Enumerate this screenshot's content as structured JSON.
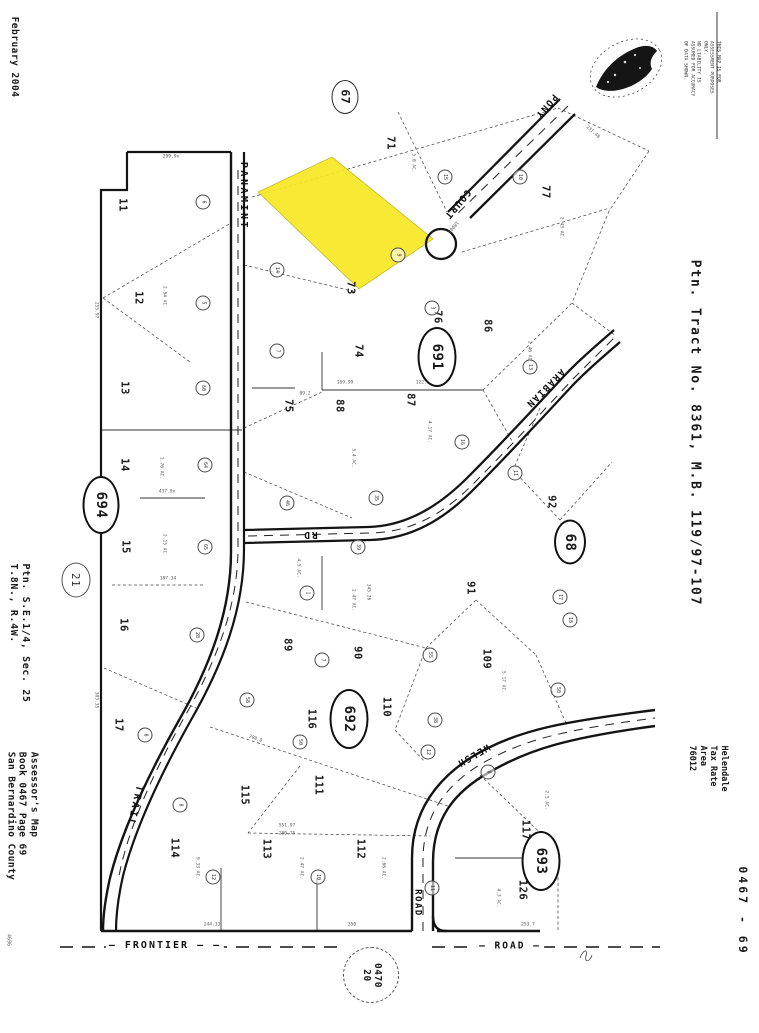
{
  "margins": {
    "date": "February 2004",
    "disclaimer": [
      "THIS MAP IS FOR ASSESSMENT PURPOSES ONLY.",
      "NO LIABILITY IS ASSUMED FOR ACCURACY OF DATA SHOWN."
    ],
    "tract": "Ptn. Tract No. 8361, M.B. 119/97-107",
    "section": [
      "Ptn. S.E.1/4, Sec. 25",
      "T.8N., R.4W."
    ],
    "assessor": [
      "Assessor's Map",
      "Book 0467 Page 69",
      "San Bernardino County"
    ],
    "tax_area": [
      "Helendale",
      "Tax Rate Area",
      "76012"
    ],
    "page_code": "0467 - 69",
    "corner_code": "4696"
  },
  "map": {
    "highlight_color": "#f6e723",
    "parcels": [
      {
        "n": "11",
        "x": 122,
        "y": 205
      },
      {
        "n": "12",
        "x": 138,
        "y": 298
      },
      {
        "n": "13",
        "x": 124,
        "y": 388
      },
      {
        "n": "14",
        "x": 124,
        "y": 465
      },
      {
        "n": "15",
        "x": 125,
        "y": 547
      },
      {
        "n": "16",
        "x": 123,
        "y": 625
      },
      {
        "n": "17",
        "x": 118,
        "y": 725
      },
      {
        "n": "71",
        "x": 390,
        "y": 143
      },
      {
        "n": "73",
        "x": 350,
        "y": 288
      },
      {
        "n": "74",
        "x": 358,
        "y": 351
      },
      {
        "n": "75",
        "x": 288,
        "y": 406
      },
      {
        "n": "76",
        "x": 437,
        "y": 317
      },
      {
        "n": "77",
        "x": 545,
        "y": 192
      },
      {
        "n": "86",
        "x": 487,
        "y": 326
      },
      {
        "n": "87",
        "x": 410,
        "y": 400
      },
      {
        "n": "88",
        "x": 339,
        "y": 406
      },
      {
        "n": "89",
        "x": 287,
        "y": 645
      },
      {
        "n": "90",
        "x": 357,
        "y": 653
      },
      {
        "n": "91",
        "x": 470,
        "y": 588
      },
      {
        "n": "92",
        "x": 551,
        "y": 502
      },
      {
        "n": "109",
        "x": 486,
        "y": 659
      },
      {
        "n": "110",
        "x": 386,
        "y": 707
      },
      {
        "n": "111",
        "x": 318,
        "y": 785
      },
      {
        "n": "112",
        "x": 360,
        "y": 849
      },
      {
        "n": "113",
        "x": 266,
        "y": 849
      },
      {
        "n": "114",
        "x": 174,
        "y": 848
      },
      {
        "n": "115",
        "x": 244,
        "y": 795
      },
      {
        "n": "116",
        "x": 311,
        "y": 719
      },
      {
        "n": "117",
        "x": 525,
        "y": 830
      },
      {
        "n": "126",
        "x": 522,
        "y": 890
      }
    ],
    "page_refs": [
      {
        "label": "67",
        "x": 345,
        "y": 97,
        "w": 25,
        "h": 32,
        "style": "thin"
      },
      {
        "label": "691",
        "x": 437,
        "y": 357,
        "w": 35,
        "h": 56,
        "style": "bold"
      },
      {
        "label": "692",
        "x": 349,
        "y": 719,
        "w": 35,
        "h": 56,
        "style": "bold"
      },
      {
        "label": "693",
        "x": 541,
        "y": 861,
        "w": 35,
        "h": 56,
        "style": "bold"
      },
      {
        "label": "694",
        "x": 101,
        "y": 505,
        "w": 33,
        "h": 54,
        "style": "bold"
      },
      {
        "label": "68",
        "x": 570,
        "y": 542,
        "w": 28,
        "h": 41,
        "style": "bold"
      },
      {
        "label": "21",
        "x": 76,
        "y": 580,
        "w": 27,
        "h": 33,
        "style": "soft"
      }
    ],
    "adjacent_page_ref": {
      "lines": [
        "0470",
        "20"
      ],
      "x": 371,
      "y": 975,
      "w": 54,
      "h": 54
    },
    "roads": [
      {
        "name": "PANAMINT",
        "x": 243,
        "y": 196,
        "r": 90,
        "fs": 10,
        "ls": 2.5
      },
      {
        "name": "TRAIL",
        "x": 134,
        "y": 806,
        "r": 103,
        "fs": 10,
        "ls": 2.5
      },
      {
        "name": "PONY",
        "x": 546,
        "y": 106,
        "r": 130,
        "fs": 9.5,
        "ls": 1.5
      },
      {
        "name": "COURT",
        "x": 457,
        "y": 204,
        "r": 130,
        "fs": 9.5,
        "ls": 1.5
      },
      {
        "name": "ARABIAN",
        "x": 545,
        "y": 388,
        "r": 135,
        "fs": 9.5,
        "ls": 1.5
      },
      {
        "name": "RD",
        "x": 310,
        "y": 534,
        "r": 180,
        "fs": 9.5,
        "ls": 2
      },
      {
        "name": "WELSH",
        "x": 473,
        "y": 755,
        "r": 150,
        "fs": 9.5,
        "ls": 1.5
      },
      {
        "name": "ROAD",
        "x": 417,
        "y": 903,
        "r": 90,
        "fs": 9,
        "ls": 1.5
      },
      {
        "name": "— FRONTIER — —",
        "x": 165,
        "y": 946,
        "r": 0,
        "fs": 10,
        "ls": 2,
        "bg": true
      },
      {
        "name": "— ROAD —",
        "x": 510,
        "y": 946,
        "r": 0,
        "fs": 9.5,
        "ls": 2,
        "bg": true
      }
    ],
    "ref_circles": [
      [
        203,
        202,
        "6"
      ],
      [
        203,
        303,
        "5"
      ],
      [
        203,
        388,
        "60"
      ],
      [
        205,
        465,
        "64"
      ],
      [
        205,
        547,
        "65"
      ],
      [
        197,
        635,
        "28"
      ],
      [
        247,
        700,
        "58"
      ],
      [
        145,
        735,
        "8"
      ],
      [
        277,
        270,
        "14"
      ],
      [
        277,
        351,
        "7"
      ],
      [
        287,
        503,
        "46"
      ],
      [
        358,
        547,
        "39"
      ],
      [
        307,
        593,
        "1"
      ],
      [
        322,
        660,
        "7"
      ],
      [
        430,
        655,
        "55"
      ],
      [
        376,
        498,
        "35"
      ],
      [
        520,
        177,
        "10"
      ],
      [
        445,
        177,
        "15"
      ],
      [
        398,
        255,
        "9"
      ],
      [
        432,
        308,
        "3"
      ],
      [
        530,
        367,
        "13"
      ],
      [
        462,
        442,
        "16"
      ],
      [
        515,
        473,
        "11"
      ],
      [
        570,
        620,
        "18"
      ],
      [
        558,
        690,
        "50"
      ],
      [
        435,
        720,
        "38"
      ],
      [
        180,
        805,
        "8"
      ],
      [
        300,
        742,
        "50"
      ],
      [
        213,
        877,
        "12"
      ],
      [
        318,
        877,
        "10"
      ],
      [
        428,
        752,
        "12"
      ],
      [
        488,
        772,
        "8"
      ],
      [
        432,
        888,
        "11"
      ],
      [
        560,
        597,
        "17"
      ]
    ],
    "dims": [
      {
        "t": "299.9x",
        "x": 171,
        "y": 158,
        "r": 0
      },
      {
        "t": "255.97",
        "x": 95,
        "y": 310,
        "r": 90
      },
      {
        "t": "437.9x",
        "x": 167,
        "y": 493,
        "r": 0
      },
      {
        "t": "187.34",
        "x": 168,
        "y": 580,
        "r": 0
      },
      {
        "t": "303.35",
        "x": 95,
        "y": 700,
        "r": 90
      },
      {
        "t": "169.99",
        "x": 345,
        "y": 384,
        "r": 0
      },
      {
        "t": "89.2",
        "x": 305,
        "y": 395,
        "r": 0
      },
      {
        "t": "122.97",
        "x": 424,
        "y": 384,
        "r": 0
      },
      {
        "t": "231.48",
        "x": 592,
        "y": 133,
        "r": 42
      },
      {
        "t": "18003",
        "x": 452,
        "y": 226,
        "r": 130
      },
      {
        "t": "5.0 AC.",
        "x": 412,
        "y": 163,
        "r": 90
      },
      {
        "t": "2.43 AC.",
        "x": 560,
        "y": 228,
        "r": 90
      },
      {
        "t": "2.46 AC.",
        "x": 528,
        "y": 352,
        "r": 90
      },
      {
        "t": "4.17 AC.",
        "x": 428,
        "y": 432,
        "r": 90
      },
      {
        "t": "5.4 AC.",
        "x": 352,
        "y": 458,
        "r": 90
      },
      {
        "t": "2.54 AC.",
        "x": 163,
        "y": 297,
        "r": 90
      },
      {
        "t": "1.76 AC.",
        "x": 160,
        "y": 468,
        "r": 90
      },
      {
        "t": "2.15 AC.",
        "x": 163,
        "y": 545,
        "r": 90
      },
      {
        "t": "4.5 AC.",
        "x": 297,
        "y": 568,
        "r": 90
      },
      {
        "t": "2.47 AC.",
        "x": 352,
        "y": 600,
        "r": 90
      },
      {
        "t": "345.26",
        "x": 367,
        "y": 592,
        "r": 90
      },
      {
        "t": "5.17 AC.",
        "x": 502,
        "y": 682,
        "r": 90
      },
      {
        "t": "4.55 AC.",
        "x": 348,
        "y": 732,
        "r": 90
      },
      {
        "t": "208.0",
        "x": 255,
        "y": 740,
        "r": 20
      },
      {
        "t": "551.97",
        "x": 287,
        "y": 827,
        "r": 0
      },
      {
        "t": "280.75",
        "x": 287,
        "y": 835,
        "r": 0
      },
      {
        "t": "9.33 AC.",
        "x": 196,
        "y": 868,
        "r": 90
      },
      {
        "t": "2.47 AC.",
        "x": 300,
        "y": 868,
        "r": 90
      },
      {
        "t": "2.66 AC.",
        "x": 382,
        "y": 868,
        "r": 90
      },
      {
        "t": "2.5 AC.",
        "x": 545,
        "y": 800,
        "r": 90
      },
      {
        "t": "4.3 AC.",
        "x": 497,
        "y": 898,
        "r": 90
      },
      {
        "t": "244.33",
        "x": 212,
        "y": 926,
        "r": 0
      },
      {
        "t": "350",
        "x": 352,
        "y": 926,
        "r": 0
      },
      {
        "t": "253.7",
        "x": 528,
        "y": 926,
        "r": 0
      }
    ]
  }
}
